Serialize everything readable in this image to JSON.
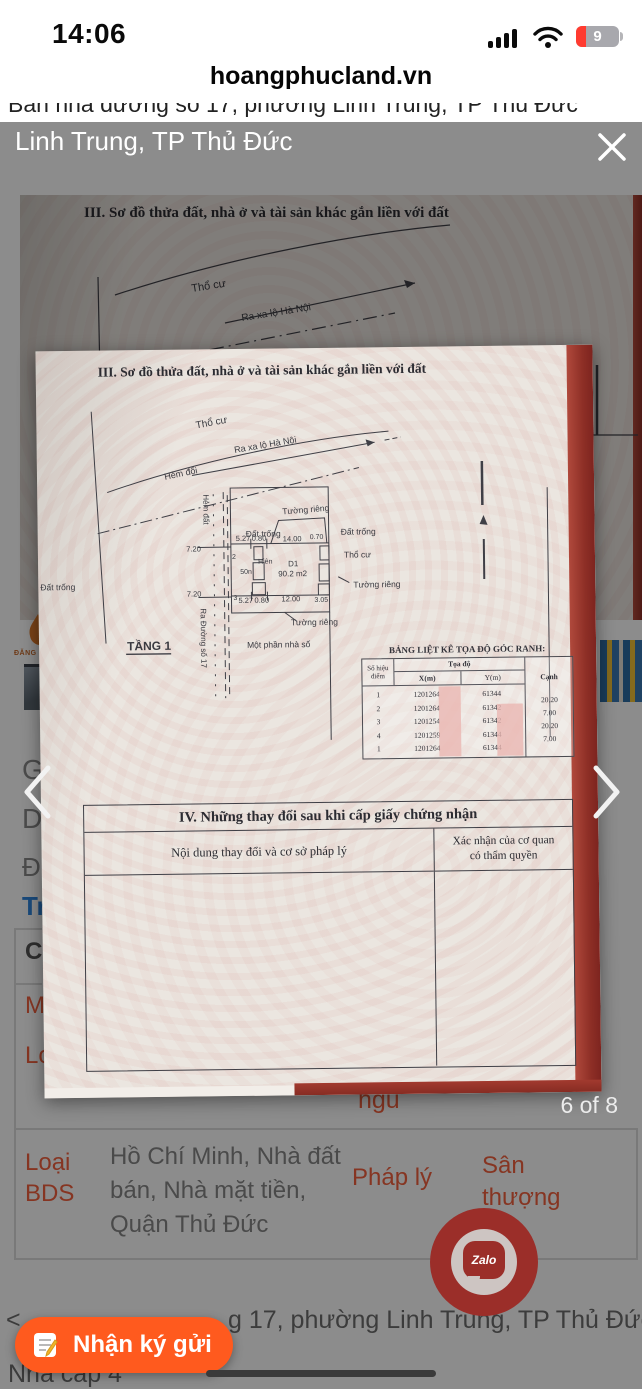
{
  "status_bar": {
    "time": "14:06",
    "battery_percent": "9"
  },
  "browser": {
    "address": "hoangphucland.vn"
  },
  "page": {
    "clipped_title": "Bán nhà đường số 17, phường Linh Trung, TP Thủ Đức",
    "fragments": {
      "f1": "Gi",
      "f2": "Di",
      "f3": "Đị",
      "f4": "Tr",
      "f5": "Ca",
      "f6": "M",
      "f7": "Lo",
      "bedroom": "ngủ",
      "logo": "ĐĂNG KH"
    },
    "info_row": {
      "label": "Loại BDS",
      "value": "Hồ Chí Minh, Nhà đất bán, Nhà mặt tiền, Quận Thủ Đức",
      "label2": "Pháp lý",
      "value2": "Sân thượng"
    },
    "address_prefix": "<",
    "address_fragment": "g 17, phường Linh Trung, TP Thủ Đức",
    "bottom_text": "Nhà cấp 4"
  },
  "lightbox": {
    "caption": "Linh Trung, TP Thủ Đức",
    "counter": "6 of 8"
  },
  "document": {
    "section3_title": "III. Sơ đồ thửa đất, nhà ở và tài sản khác gắn liền với đất",
    "bg_labels": [
      {
        "t": "Thổ cư",
        "x": 172,
        "y": 97,
        "r": -9,
        "s": 11
      },
      {
        "t": "Ra xa lộ Hà Nội",
        "x": 222,
        "y": 126,
        "r": -9,
        "s": 10
      },
      {
        "t": "Hẻm đổi",
        "x": 143,
        "y": 170,
        "r": -11,
        "s": 10
      }
    ],
    "diagram_labels": [
      {
        "t": "Thổ cư",
        "x": 160,
        "y": 32,
        "r": -10,
        "s": 10
      },
      {
        "t": "Ra xa lộ Hà Nội",
        "x": 198,
        "y": 57,
        "r": -9,
        "s": 9
      },
      {
        "t": "Hẻm đổi",
        "x": 128,
        "y": 83,
        "r": -11,
        "s": 9
      },
      {
        "t": "Hẻm đất",
        "x": 166,
        "y": 98,
        "r": 90,
        "s": 8
      },
      {
        "t": "Đất trống",
        "x": 208,
        "y": 141,
        "s": 8.5
      },
      {
        "t": "Tường riêng",
        "x": 245,
        "y": 119,
        "r": -4,
        "s": 8.5
      },
      {
        "t": "Đất trống",
        "x": 303,
        "y": 140,
        "s": 8.5
      },
      {
        "t": "Thổ cư",
        "x": 306,
        "y": 163,
        "s": 8.5
      },
      {
        "t": "Tường riêng",
        "x": 315,
        "y": 193,
        "s": 8.5
      },
      {
        "t": "Tường riêng",
        "x": 252,
        "y": 230,
        "s": 8.5
      },
      {
        "t": "Một phần nhà số",
        "x": 208,
        "y": 252,
        "s": 8.5
      },
      {
        "t": "Ra Đường số 17",
        "x": 162,
        "y": 212,
        "r": 90,
        "s": 8
      },
      {
        "t": "Đất trống",
        "x": 2,
        "y": 192,
        "s": 8.5
      },
      {
        "t": "TẦNG 1",
        "x": 88,
        "y": 253,
        "s": 12,
        "b": 600
      },
      {
        "t": "Hiên",
        "x": 220,
        "y": 168,
        "s": 7
      },
      {
        "t": "50n",
        "x": 202,
        "y": 178,
        "s": 7
      },
      {
        "t": "D1",
        "x": 250,
        "y": 171,
        "s": 8
      },
      {
        "t": "90.2 m2",
        "x": 240,
        "y": 181,
        "s": 8
      },
      {
        "t": "5.27",
        "x": 198,
        "y": 145,
        "s": 7.5
      },
      {
        "t": "0.80",
        "x": 214,
        "y": 145,
        "s": 7.5
      },
      {
        "t": "14.00",
        "x": 245,
        "y": 146,
        "s": 7.5
      },
      {
        "t": "0.70",
        "x": 272,
        "y": 144,
        "s": 7
      },
      {
        "t": "5.27",
        "x": 200,
        "y": 207,
        "s": 7.5
      },
      {
        "t": "0.80",
        "x": 216,
        "y": 207,
        "s": 7.5
      },
      {
        "t": "12.00",
        "x": 243,
        "y": 206,
        "s": 7.5
      },
      {
        "t": "3.05",
        "x": 276,
        "y": 207,
        "s": 7
      },
      {
        "t": "7.20",
        "x": 163,
        "y": 155,
        "s": 7.5,
        "a": "end"
      },
      {
        "t": "7.20",
        "x": 163,
        "y": 200,
        "s": 7.5,
        "a": "end"
      },
      {
        "t": "2",
        "x": 194,
        "y": 163,
        "s": 7
      },
      {
        "t": "3",
        "x": 195,
        "y": 204,
        "s": 7
      }
    ],
    "coord_table": {
      "title": "BẢNG LIỆT KÊ TỌA ĐỘ GÓC RANH:",
      "col_point": "Số hiệu điểm",
      "col_coord": "Tọa độ",
      "col_x": "X(m)",
      "col_y": "Y(m)",
      "col_edge": "Cạnh",
      "rows": [
        [
          "1",
          "1201264",
          "61344"
        ],
        [
          "2",
          "1201264",
          "61342"
        ],
        [
          "3",
          "1201254",
          "61342"
        ],
        [
          "4",
          "1201259",
          "61344"
        ],
        [
          "1",
          "1201264",
          "61344"
        ]
      ],
      "edges": [
        "20.20",
        "7.00",
        "20.20",
        "7.00"
      ]
    },
    "section4": {
      "title": "IV. Những thay đổi sau khi cấp giấy chứng nhận",
      "col_left": "Nội dung thay đổi và cơ sở pháp lý",
      "col_right": "Xác nhận của cơ quan có thẩm quyền"
    }
  },
  "floating": {
    "consign_label": "Nhận ký gửi",
    "zalo_text": "Zalo"
  },
  "colors": {
    "accent_orange": "#ff5a1e",
    "label_red": "#f4623e",
    "link_blue": "#2e86de",
    "cover_red": "#a63a30",
    "zalo_ring": "#9b2e29",
    "battery_red": "#ff3b30"
  }
}
